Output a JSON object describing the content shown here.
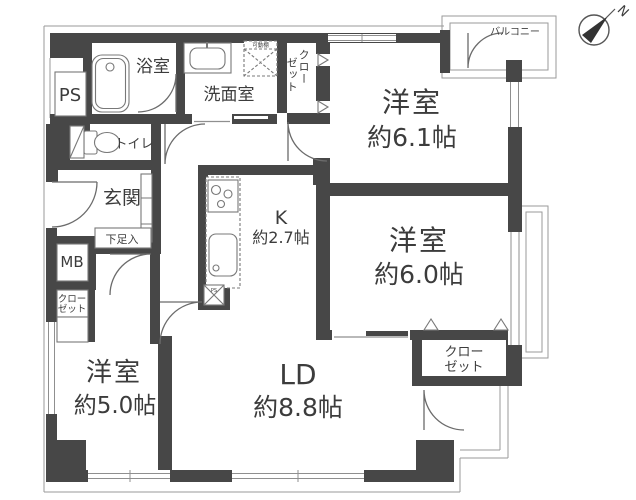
{
  "compass": {
    "north": "N"
  },
  "balcony": {
    "label": "バルコニー"
  },
  "rooms": {
    "bedroom_61": {
      "name": "洋室",
      "size": "約6.1帖"
    },
    "bedroom_60": {
      "name": "洋室",
      "size": "約6.0帖"
    },
    "bedroom_50": {
      "name": "洋室",
      "size": "約5.0帖"
    },
    "living_dining": {
      "name": "LD",
      "size": "約8.8帖"
    },
    "kitchen": {
      "name": "K",
      "size": "約2.7帖"
    },
    "bathroom": {
      "label": "浴室"
    },
    "washroom": {
      "label": "洗面室"
    },
    "toilet": {
      "label": "トイレ"
    },
    "entrance": {
      "label": "玄関"
    },
    "shoe_box": {
      "label": "下足入"
    }
  },
  "closets": {
    "bedroom61_closet": {
      "col1": "クロー",
      "col2": "ゼット"
    },
    "bedroom60_closet": {
      "line1": "クロー",
      "line2": "ゼット"
    },
    "hall_closet": {
      "line1": "クロー",
      "line2": "ゼット"
    }
  },
  "utilities": {
    "ps": "PS",
    "mb": "MB",
    "ps_small": "PS",
    "movable_shelf": "可動棚"
  },
  "colors": {
    "wall": "#474747",
    "thin_line": "#8f8f8f",
    "text": "#3c3c3c"
  }
}
